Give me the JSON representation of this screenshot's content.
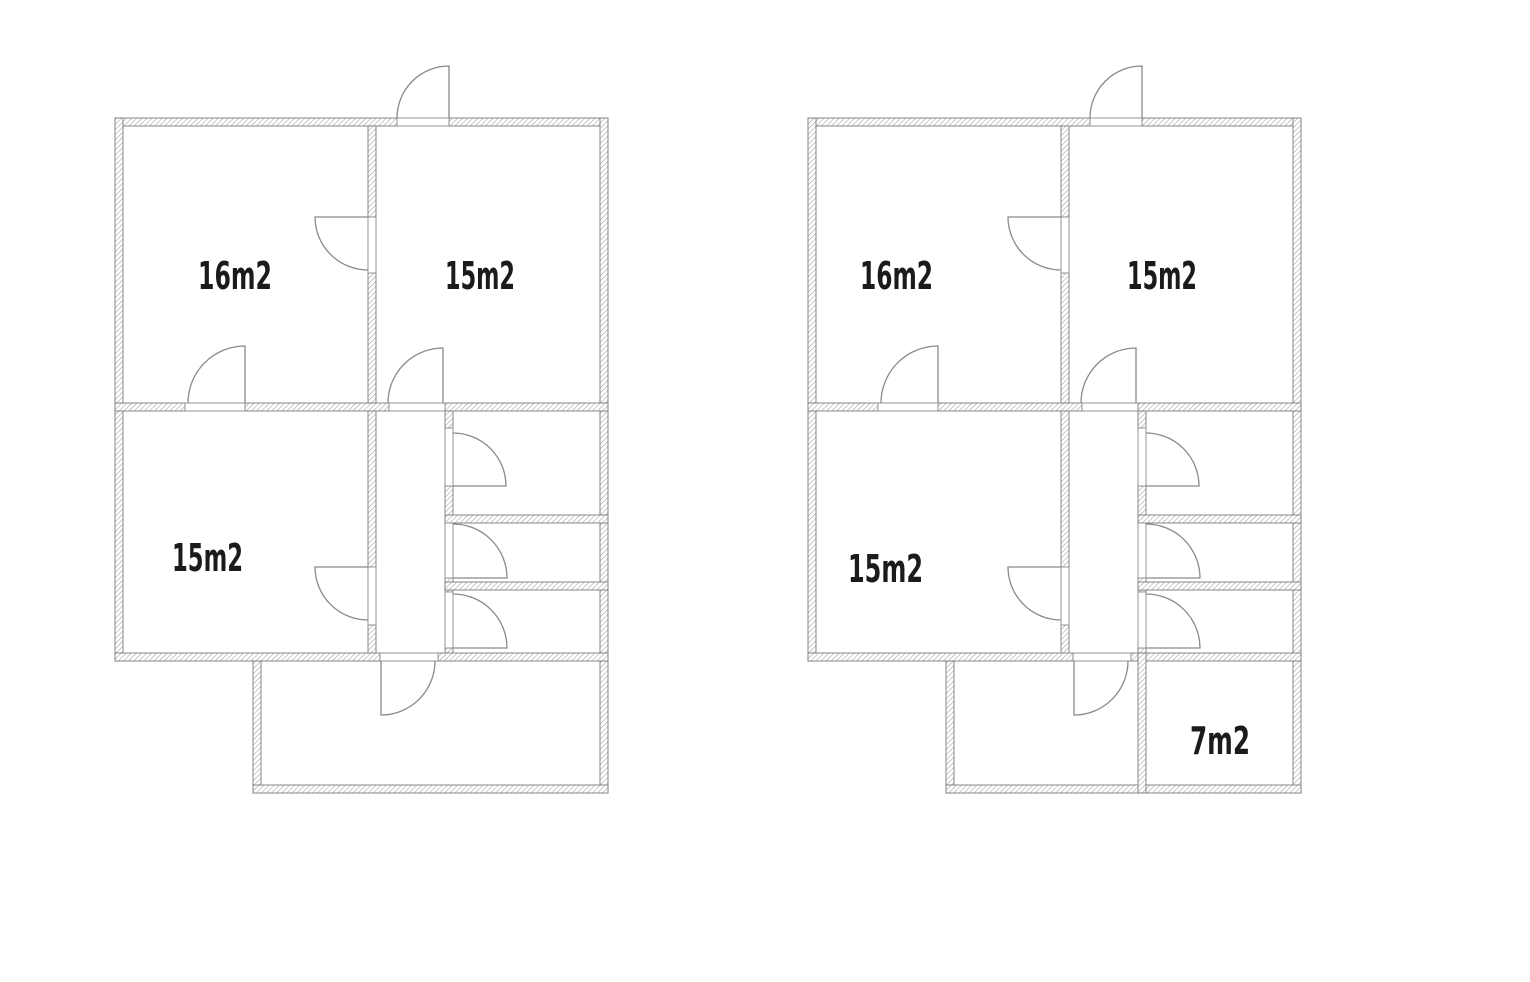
{
  "canvas": {
    "width": 1530,
    "height": 982,
    "background": "#ffffff"
  },
  "style": {
    "wall_outline_color": "#7b7b7b",
    "wall_hatch_color": "#9e9e9e",
    "door_color": "#8a8a8a",
    "threshold_color": "#8a8a8a",
    "label_color": "#1b1b1b"
  },
  "plans": [
    {
      "id": "floor-plan-left",
      "rooms": [
        {
          "label": "16m2",
          "x": 198,
          "baseline": 289,
          "width": 74
        },
        {
          "label": "15m2",
          "x": 445,
          "baseline": 289,
          "width": 70
        },
        {
          "label": "15m2",
          "x": 172,
          "baseline": 571,
          "width": 71
        }
      ],
      "walls": [
        [
          115,
          118,
          282,
          8
        ],
        [
          449,
          118,
          159,
          8
        ],
        [
          115,
          118,
          8,
          543
        ],
        [
          600,
          118,
          8,
          675
        ],
        [
          115,
          403,
          70,
          8
        ],
        [
          245,
          403,
          144,
          8
        ],
        [
          445,
          403,
          163,
          8
        ],
        [
          368,
          126,
          8,
          91
        ],
        [
          368,
          273,
          8,
          130
        ],
        [
          368,
          411,
          8,
          156
        ],
        [
          368,
          625,
          8,
          36
        ],
        [
          445,
          411,
          8,
          17
        ],
        [
          445,
          486,
          8,
          37
        ],
        [
          445,
          578,
          8,
          14
        ],
        [
          445,
          648,
          8,
          13
        ],
        [
          445,
          515,
          163,
          8
        ],
        [
          445,
          582,
          163,
          8
        ],
        [
          115,
          653,
          265,
          8
        ],
        [
          438,
          653,
          170,
          8
        ],
        [
          253,
          661,
          8,
          132
        ],
        [
          253,
          785,
          355,
          8
        ]
      ],
      "thresholds": [
        [
          397,
          118,
          52,
          8
        ],
        [
          368,
          217,
          8,
          56
        ],
        [
          185,
          403,
          60,
          8
        ],
        [
          389,
          403,
          56,
          8
        ],
        [
          368,
          567,
          8,
          58
        ],
        [
          445,
          428,
          8,
          58
        ],
        [
          445,
          523,
          8,
          55
        ],
        [
          445,
          592,
          8,
          56
        ],
        [
          380,
          653,
          58,
          8
        ]
      ],
      "doors": [
        [
          449,
          118,
          52,
          270,
          180
        ],
        [
          368,
          217,
          53,
          180,
          90
        ],
        [
          245,
          403,
          57,
          270,
          180
        ],
        [
          443,
          403,
          55,
          270,
          180
        ],
        [
          368,
          567,
          53,
          180,
          90
        ],
        [
          453,
          486,
          53,
          0,
          270
        ],
        [
          453,
          578,
          54,
          0,
          270
        ],
        [
          453,
          648,
          54,
          0,
          270
        ],
        [
          381,
          661,
          54,
          90,
          0
        ]
      ]
    },
    {
      "id": "floor-plan-right",
      "rooms": [
        {
          "label": "16m2",
          "x": 860,
          "baseline": 289,
          "width": 73
        },
        {
          "label": "15m2",
          "x": 1127,
          "baseline": 289,
          "width": 70
        },
        {
          "label": "15m2",
          "x": 848,
          "baseline": 582,
          "width": 75
        },
        {
          "label": "7m2",
          "x": 1190,
          "baseline": 754,
          "width": 60
        }
      ],
      "walls": [
        [
          808,
          118,
          282,
          8
        ],
        [
          1142,
          118,
          159,
          8
        ],
        [
          808,
          118,
          8,
          543
        ],
        [
          1293,
          118,
          8,
          675
        ],
        [
          808,
          403,
          70,
          8
        ],
        [
          938,
          403,
          144,
          8
        ],
        [
          1138,
          403,
          163,
          8
        ],
        [
          1061,
          126,
          8,
          91
        ],
        [
          1061,
          273,
          8,
          130
        ],
        [
          1061,
          411,
          8,
          156
        ],
        [
          1061,
          625,
          8,
          36
        ],
        [
          1138,
          411,
          8,
          17
        ],
        [
          1138,
          486,
          8,
          37
        ],
        [
          1138,
          578,
          8,
          14
        ],
        [
          1138,
          648,
          8,
          13
        ],
        [
          1138,
          515,
          163,
          8
        ],
        [
          1138,
          582,
          163,
          8
        ],
        [
          808,
          653,
          265,
          8
        ],
        [
          1131,
          653,
          170,
          8
        ],
        [
          946,
          661,
          8,
          132
        ],
        [
          946,
          785,
          355,
          8
        ],
        [
          1138,
          653,
          8,
          140
        ]
      ],
      "thresholds": [
        [
          1090,
          118,
          52,
          8
        ],
        [
          1061,
          217,
          8,
          56
        ],
        [
          878,
          403,
          60,
          8
        ],
        [
          1082,
          403,
          56,
          8
        ],
        [
          1061,
          567,
          8,
          58
        ],
        [
          1138,
          428,
          8,
          58
        ],
        [
          1138,
          523,
          8,
          55
        ],
        [
          1138,
          592,
          8,
          56
        ],
        [
          1073,
          653,
          58,
          8
        ]
      ],
      "doors": [
        [
          1142,
          118,
          52,
          270,
          180
        ],
        [
          1061,
          217,
          53,
          180,
          90
        ],
        [
          938,
          403,
          57,
          270,
          180
        ],
        [
          1136,
          403,
          55,
          270,
          180
        ],
        [
          1061,
          567,
          53,
          180,
          90
        ],
        [
          1146,
          486,
          53,
          0,
          270
        ],
        [
          1146,
          578,
          54,
          0,
          270
        ],
        [
          1146,
          648,
          54,
          0,
          270
        ],
        [
          1074,
          661,
          54,
          90,
          0
        ]
      ]
    }
  ]
}
